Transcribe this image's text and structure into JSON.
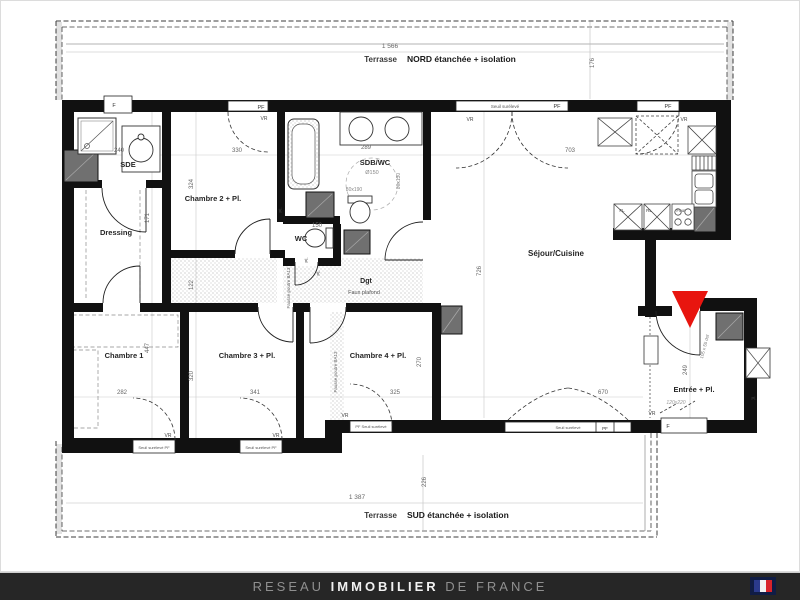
{
  "plan": {
    "accent_red": "#e8150f",
    "wall_color": "#111111",
    "shaft_color": "#707070",
    "labels": [
      {
        "n": "terrasse-nord-dim-width",
        "t": "1 566",
        "x": 390,
        "y": 48,
        "s": 6.5,
        "c": "#666"
      },
      {
        "n": "terrasse-nord-prefix",
        "t": "Terrasse",
        "x": 397,
        "y": 62,
        "s": 8,
        "w": 700,
        "c": "#3a3a3a",
        "a": "end"
      },
      {
        "n": "terrasse-nord-title",
        "t": "NORD étanchée + isolation",
        "x": 407,
        "y": 62,
        "s": 8.5,
        "w": 700,
        "c": "#1a1a1a",
        "a": "start"
      },
      {
        "n": "terrasse-nord-dim-depth",
        "t": "176",
        "x": 594,
        "y": 63,
        "s": 6,
        "c": "#666",
        "r": -90
      },
      {
        "n": "terrasse-sud-dim-width",
        "t": "1 387",
        "x": 357,
        "y": 499,
        "s": 6.5,
        "c": "#666"
      },
      {
        "n": "terrasse-sud-prefix",
        "t": "Terrasse",
        "x": 397,
        "y": 518,
        "s": 8,
        "w": 700,
        "c": "#3a3a3a",
        "a": "end"
      },
      {
        "n": "terrasse-sud-title",
        "t": "SUD étanchée + isolation",
        "x": 407,
        "y": 518,
        "s": 8.5,
        "w": 700,
        "c": "#1a1a1a",
        "a": "start"
      },
      {
        "n": "terrasse-sud-dim-depth",
        "t": "226",
        "x": 426,
        "y": 482,
        "s": 6,
        "c": "#666",
        "r": -90
      },
      {
        "n": "room-sde",
        "t": "SDE",
        "x": 128,
        "y": 167,
        "s": 7.5,
        "w": 700,
        "c": "#262626"
      },
      {
        "n": "room-dressing",
        "t": "Dressing",
        "x": 116,
        "y": 235,
        "s": 7.5,
        "w": 700,
        "c": "#262626"
      },
      {
        "n": "room-chambre-2",
        "t": "Chambre 2 + Pl.",
        "x": 213,
        "y": 201,
        "s": 7.5,
        "w": 700,
        "c": "#262626"
      },
      {
        "n": "room-sdb-wc",
        "t": "SDB/WC",
        "x": 375,
        "y": 165,
        "s": 7.5,
        "w": 700,
        "c": "#262626"
      },
      {
        "n": "room-wc",
        "t": "WC",
        "x": 301,
        "y": 241,
        "s": 7.5,
        "w": 700,
        "c": "#262626"
      },
      {
        "n": "room-dgt",
        "t": "Dgt",
        "x": 366,
        "y": 283,
        "s": 7,
        "w": 700,
        "c": "#262626"
      },
      {
        "n": "room-dgt-note",
        "t": "Faux plafond",
        "x": 364,
        "y": 294,
        "s": 5.5,
        "c": "#555"
      },
      {
        "n": "room-sejour-cuisine",
        "t": "Séjour/Cuisine",
        "x": 556,
        "y": 256,
        "s": 8,
        "w": 700,
        "c": "#262626"
      },
      {
        "n": "room-chambre-1",
        "t": "Chambre 1",
        "x": 124,
        "y": 358,
        "s": 7.5,
        "w": 700,
        "c": "#262626"
      },
      {
        "n": "room-chambre-3",
        "t": "Chambre 3 + Pl.",
        "x": 247,
        "y": 358,
        "s": 7.5,
        "w": 700,
        "c": "#262626"
      },
      {
        "n": "room-chambre-4",
        "t": "Chambre 4 + Pl.",
        "x": 378,
        "y": 358,
        "s": 7.5,
        "w": 700,
        "c": "#262626"
      },
      {
        "n": "room-entree",
        "t": "Entrée + Pl.",
        "x": 694,
        "y": 392,
        "s": 7.5,
        "w": 700,
        "c": "#262626"
      },
      {
        "n": "dim",
        "t": "240",
        "x": 119,
        "y": 152,
        "s": 6,
        "c": "#666"
      },
      {
        "n": "dim",
        "t": "330",
        "x": 237,
        "y": 152,
        "s": 6,
        "c": "#666"
      },
      {
        "n": "dim",
        "t": "289",
        "x": 366,
        "y": 149,
        "s": 6,
        "c": "#666"
      },
      {
        "n": "dim",
        "t": "703",
        "x": 570,
        "y": 152,
        "s": 6,
        "c": "#666"
      },
      {
        "n": "dim",
        "t": "324",
        "x": 193,
        "y": 184,
        "s": 6,
        "c": "#666",
        "r": -90
      },
      {
        "n": "dim",
        "t": "171",
        "x": 149,
        "y": 218,
        "s": 6,
        "c": "#666",
        "r": -90
      },
      {
        "n": "dim",
        "t": "122",
        "x": 193,
        "y": 285,
        "s": 6,
        "c": "#666",
        "r": -90
      },
      {
        "n": "dim",
        "t": "447",
        "x": 149,
        "y": 348,
        "s": 6,
        "c": "#666",
        "r": -90
      },
      {
        "n": "dim",
        "t": "320",
        "x": 193,
        "y": 376,
        "s": 6,
        "c": "#666",
        "r": -90
      },
      {
        "n": "dim",
        "t": "270",
        "x": 421,
        "y": 362,
        "s": 6,
        "c": "#666",
        "r": -90
      },
      {
        "n": "dim",
        "t": "726",
        "x": 481,
        "y": 271,
        "s": 6,
        "c": "#666",
        "r": -90
      },
      {
        "n": "dim",
        "t": "282",
        "x": 122,
        "y": 394,
        "s": 6,
        "c": "#666"
      },
      {
        "n": "dim",
        "t": "341",
        "x": 255,
        "y": 394,
        "s": 6,
        "c": "#666"
      },
      {
        "n": "dim",
        "t": "325",
        "x": 395,
        "y": 394,
        "s": 6,
        "c": "#666"
      },
      {
        "n": "dim",
        "t": "670",
        "x": 603,
        "y": 394,
        "s": 6,
        "c": "#666"
      },
      {
        "n": "dim",
        "t": "150",
        "x": 317,
        "y": 227,
        "s": 6,
        "c": "#666"
      },
      {
        "n": "dim",
        "t": "249",
        "x": 687,
        "y": 370,
        "s": 6,
        "c": "#666",
        "r": -90
      },
      {
        "n": "dim",
        "t": "Ø150",
        "x": 372,
        "y": 174,
        "s": 5.5,
        "c": "#888"
      },
      {
        "n": "dim",
        "t": "80x190",
        "x": 354,
        "y": 191,
        "s": 5,
        "c": "#888"
      },
      {
        "n": "dim",
        "t": "80x130",
        "x": 400,
        "y": 181,
        "s": 5,
        "c": "#888",
        "r": -90
      },
      {
        "n": "dim",
        "t": "120x220",
        "x": 676,
        "y": 404,
        "s": 5,
        "c": "#999",
        "i": 1
      },
      {
        "n": "door-note",
        "t": "105 x 55 dsf",
        "x": 706,
        "y": 347,
        "s": 4.5,
        "c": "#777",
        "r": -75
      },
      {
        "n": "window-label",
        "t": "F",
        "x": 114,
        "y": 107,
        "s": 5.5,
        "c": "#333"
      },
      {
        "n": "window-label",
        "t": "PF",
        "x": 261,
        "y": 109,
        "s": 5.5,
        "c": "#333"
      },
      {
        "n": "window-label",
        "t": "Seuil surélevé",
        "x": 505,
        "y": 108,
        "s": 4.5,
        "c": "#555"
      },
      {
        "n": "window-label",
        "t": "PF",
        "x": 557,
        "y": 108,
        "s": 5.5,
        "c": "#333"
      },
      {
        "n": "window-label",
        "t": "PF",
        "x": 668,
        "y": 108,
        "s": 5.5,
        "c": "#333"
      },
      {
        "n": "vent-label",
        "t": "VR",
        "x": 264,
        "y": 120,
        "s": 5,
        "c": "#444"
      },
      {
        "n": "vent-label",
        "t": "VR",
        "x": 470,
        "y": 121,
        "s": 5,
        "c": "#444"
      },
      {
        "n": "vent-label",
        "t": "VR",
        "x": 684,
        "y": 121,
        "s": 5,
        "c": "#444"
      },
      {
        "n": "vent-label",
        "t": "VR",
        "x": 168,
        "y": 437,
        "s": 5,
        "c": "#444"
      },
      {
        "n": "vent-label",
        "t": "VR",
        "x": 276,
        "y": 437,
        "s": 5,
        "c": "#444"
      },
      {
        "n": "vent-label",
        "t": "VR",
        "x": 345,
        "y": 417,
        "s": 5,
        "c": "#444"
      },
      {
        "n": "vent-label",
        "t": "VR",
        "x": 652,
        "y": 415,
        "s": 5,
        "c": "#444"
      },
      {
        "n": "window-label",
        "t": "Seuil surélevé PF",
        "x": 154,
        "y": 449,
        "s": 4,
        "c": "#555"
      },
      {
        "n": "window-label",
        "t": "Seuil surélevé PF",
        "x": 261,
        "y": 449,
        "s": 4,
        "c": "#555"
      },
      {
        "n": "window-label",
        "t": "PF Seuil surélevé",
        "x": 371,
        "y": 428,
        "s": 4,
        "c": "#555"
      },
      {
        "n": "window-label",
        "t": "Seuil surélevé",
        "x": 568,
        "y": 429,
        "s": 4,
        "c": "#555"
      },
      {
        "n": "window-label",
        "t": "PF",
        "x": 605,
        "y": 430,
        "s": 4.5,
        "c": "#333"
      },
      {
        "n": "window-label",
        "t": "F",
        "x": 668,
        "y": 428,
        "s": 5.5,
        "c": "#333"
      },
      {
        "n": "kitchen-label",
        "t": "Four",
        "x": 681,
        "y": 212,
        "s": 4.5,
        "c": "#444"
      },
      {
        "n": "kitchen-label",
        "t": "FL",
        "x": 622,
        "y": 212,
        "s": 4.5,
        "c": "#444"
      },
      {
        "n": "kitchen-label",
        "t": "RL",
        "x": 649,
        "y": 212,
        "s": 4.5,
        "c": "#444"
      },
      {
        "n": "beam-note",
        "t": "Fausse poutre BA13",
        "x": 290,
        "y": 288,
        "s": 4.5,
        "c": "#666",
        "r": -90
      },
      {
        "n": "beam-note",
        "t": "Fausse poutre BA13",
        "x": 337,
        "y": 372,
        "s": 4.5,
        "c": "#666",
        "r": -90
      },
      {
        "n": "closet-label",
        "t": "Pl.",
        "x": 282,
        "y": 210,
        "s": 4.5,
        "c": "#444",
        "r": -90
      },
      {
        "n": "closet-label",
        "t": "Pl.",
        "x": 308,
        "y": 260,
        "s": 4.5,
        "c": "#444",
        "r": -90
      },
      {
        "n": "closet-label",
        "t": "Pl.",
        "x": 320,
        "y": 273,
        "s": 4.5,
        "c": "#444",
        "r": -90
      },
      {
        "n": "closet-label",
        "t": "Pl.",
        "x": 754,
        "y": 400,
        "s": 4.5,
        "c": "#444"
      }
    ]
  },
  "footer": {
    "brand_prefix": "RESEAU ",
    "brand_emphasis": "IMMOBILIER",
    "brand_suffix": " DE FRANCE",
    "bar_color": "#262626",
    "text_dim": "#8f8f8f",
    "text_bright": "#f1f1f1",
    "flag": {
      "backing": "#101c45",
      "blue": "#2b3a8c",
      "white": "#f2f2f2",
      "red": "#d8232a"
    }
  }
}
